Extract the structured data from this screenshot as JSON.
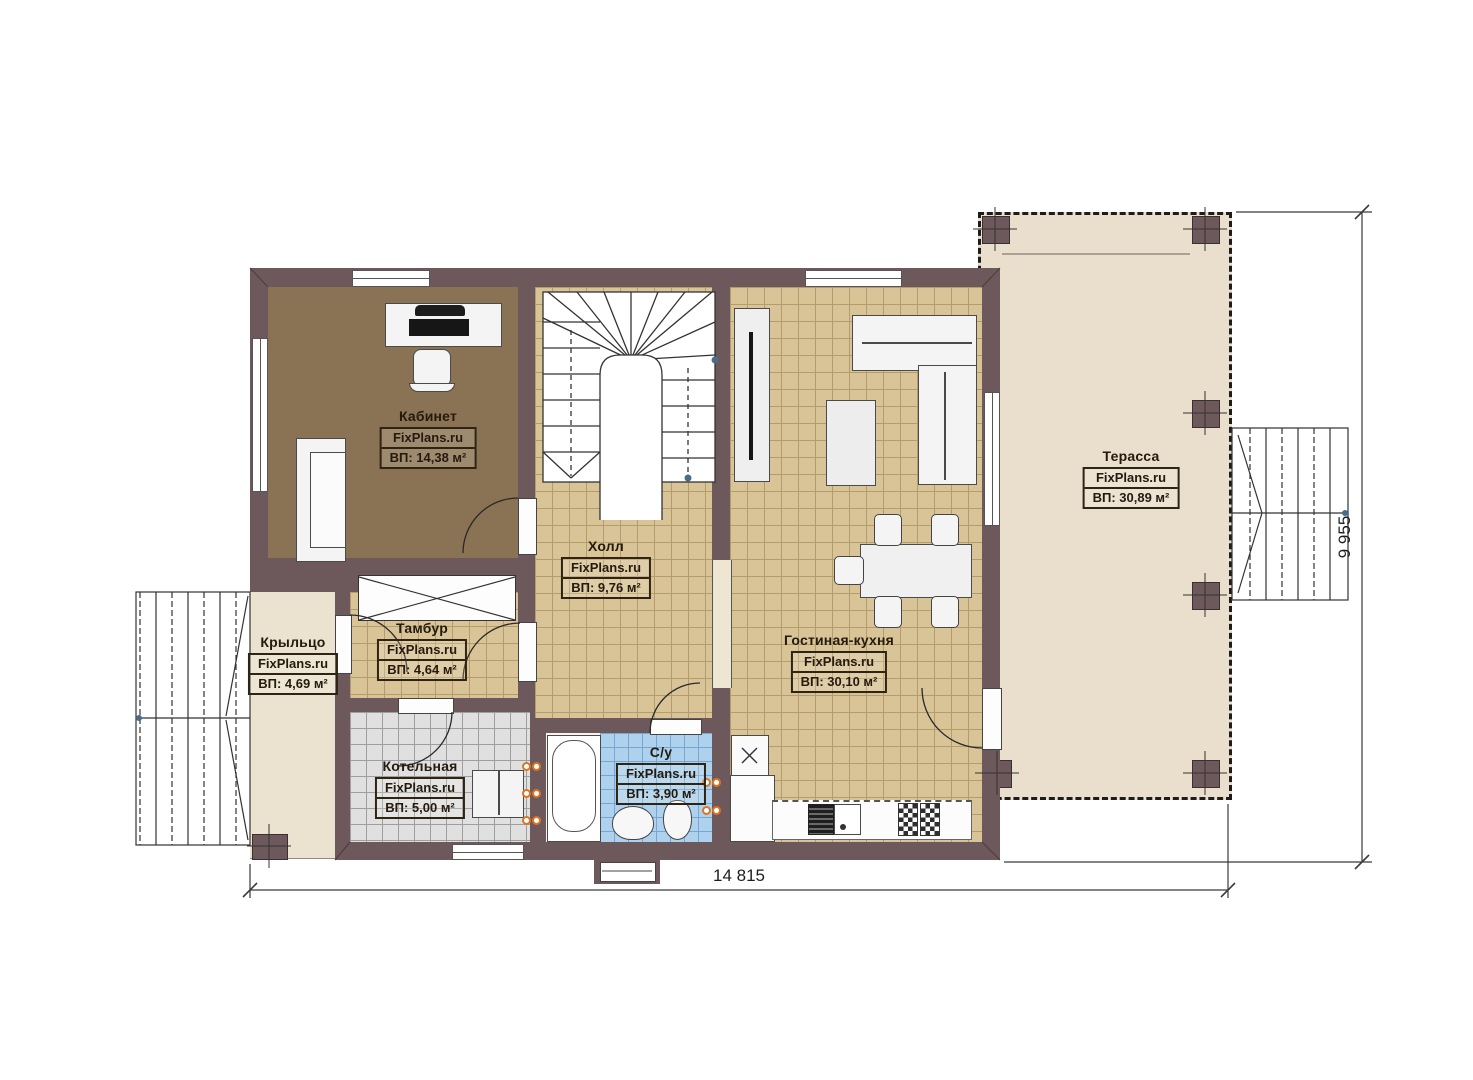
{
  "plan_title": "First floor plan",
  "watermark": "FixPlans.ru",
  "rooms": {
    "kabinet": {
      "name": "Кабинет",
      "watermark": "FixPlans.ru",
      "area": "ВП: 14,38 м²"
    },
    "holl": {
      "name": "Холл",
      "watermark": "FixPlans.ru",
      "area": "ВП: 9,76 м²"
    },
    "tambur": {
      "name": "Тамбур",
      "watermark": "FixPlans.ru",
      "area": "ВП: 4,64 м²"
    },
    "krylco": {
      "name": "Крыльцо",
      "watermark": "FixPlans.ru",
      "area": "ВП: 4,69 м²"
    },
    "kotelnaya": {
      "name": "Котельная",
      "watermark": "FixPlans.ru",
      "area": "ВП: 5,00 м²"
    },
    "su": {
      "name": "С/у",
      "watermark": "FixPlans.ru",
      "area": "ВП: 3,90 м²"
    },
    "gostinaya": {
      "name": "Гостиная-кухня",
      "watermark": "FixPlans.ru",
      "area": "ВП: 30,10 м²"
    },
    "terassa": {
      "name": "Терасса",
      "watermark": "FixPlans.ru",
      "area": "ВП: 30,89 м²"
    }
  },
  "dimensions": {
    "width_label": "14 815",
    "height_label": "9 955"
  },
  "colors": {
    "wall": "#6d595b",
    "floor_office": "#8a7254",
    "floor_tile_beige": "#d9c498",
    "floor_tile_gray": "#e0e0e0",
    "floor_tile_blue": "#aed2ee",
    "floor_terrace": "#e9dfcc",
    "radiator_accent": "#e0731f",
    "label_ink": "#241a0e"
  }
}
